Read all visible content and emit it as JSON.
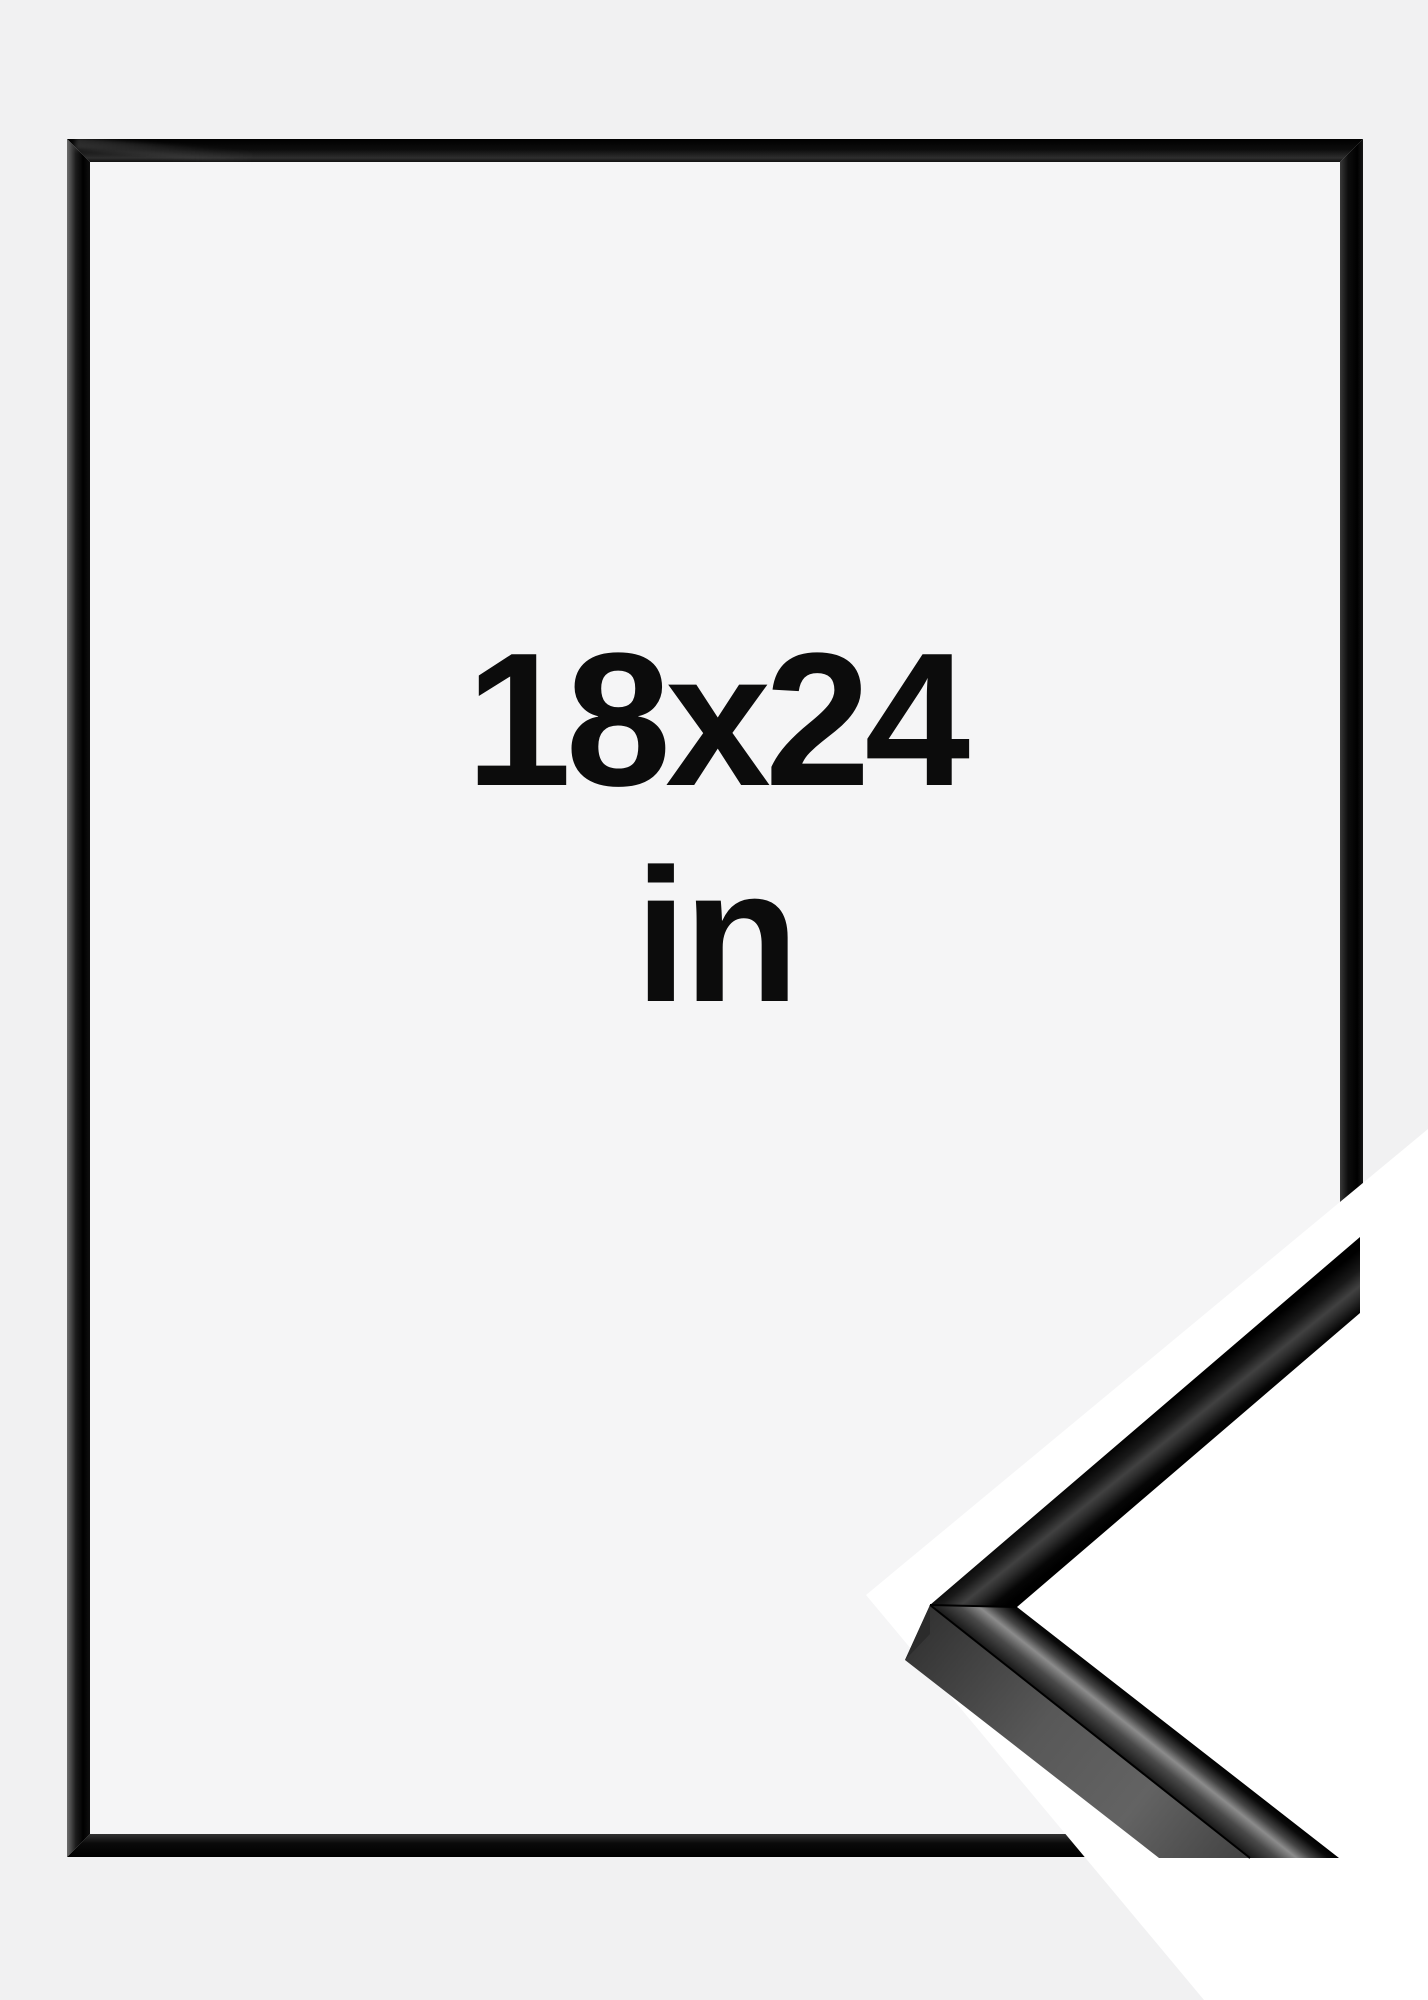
{
  "size_label": {
    "value": "18x24",
    "unit": "in"
  },
  "colors": {
    "page_bg": "#f1f1f2",
    "interior_bg": "#f5f5f6",
    "frame_black": "#0b0b0b",
    "text": "#0c0c0c",
    "cutout_white": "#ffffff",
    "sample_side_gray": "#565656"
  }
}
